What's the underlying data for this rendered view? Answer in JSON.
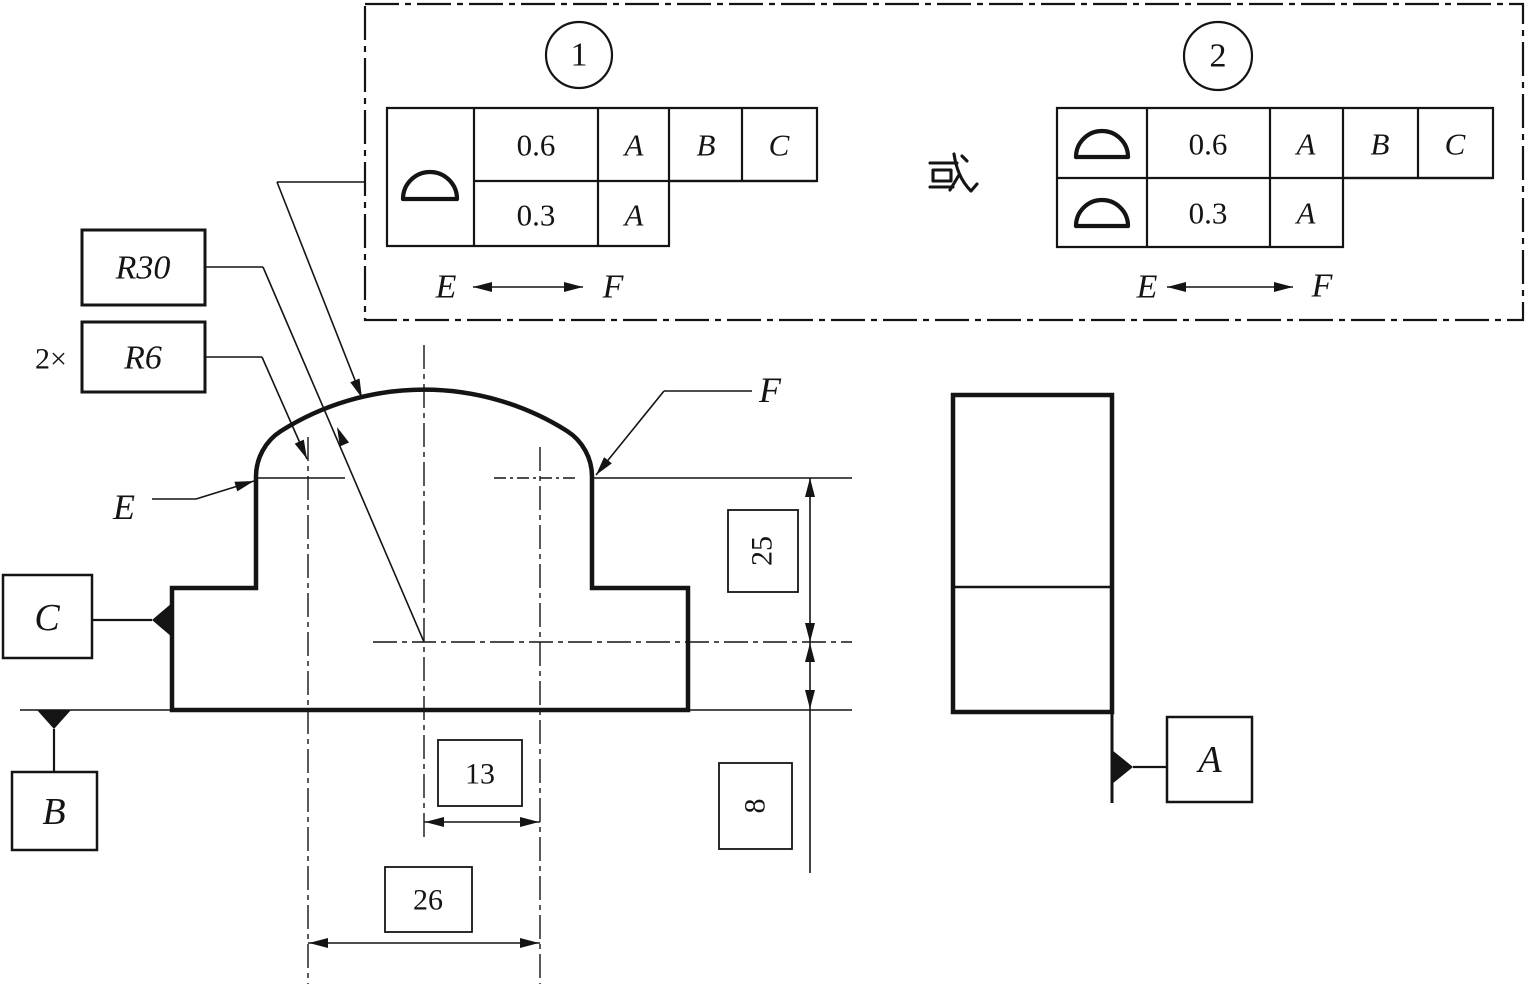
{
  "colors": {
    "ink": "#141414",
    "background": "#ffffff"
  },
  "drawing": {
    "alternatives_panel": {
      "or_text": "或",
      "callouts": [
        {
          "number": "1",
          "symbol": "profile-of-a-surface",
          "rows": [
            {
              "tolerance": "0.6",
              "datums": [
                "A",
                "B",
                "C"
              ]
            },
            {
              "tolerance": "0.3",
              "datums": [
                "A"
              ]
            }
          ],
          "extent": {
            "from": "E",
            "to": "F"
          }
        },
        {
          "number": "2",
          "symbol": "profile-of-a-surface",
          "rows": [
            {
              "tolerance": "0.6",
              "datums": [
                "A",
                "B",
                "C"
              ]
            },
            {
              "tolerance": "0.3",
              "datums": [
                "A"
              ]
            }
          ],
          "extent": {
            "from": "E",
            "to": "F"
          }
        }
      ]
    },
    "radius_callouts": {
      "count_prefix": "2×",
      "large_radius": "R30",
      "fillet_radius": "R6"
    },
    "dimensions": {
      "upper_height": "25",
      "base_height": "8",
      "half_width": "13",
      "full_width": "26"
    },
    "point_labels": {
      "e": "E",
      "f": "F"
    },
    "datum_labels": {
      "a": "A",
      "b": "B",
      "c": "C"
    }
  }
}
